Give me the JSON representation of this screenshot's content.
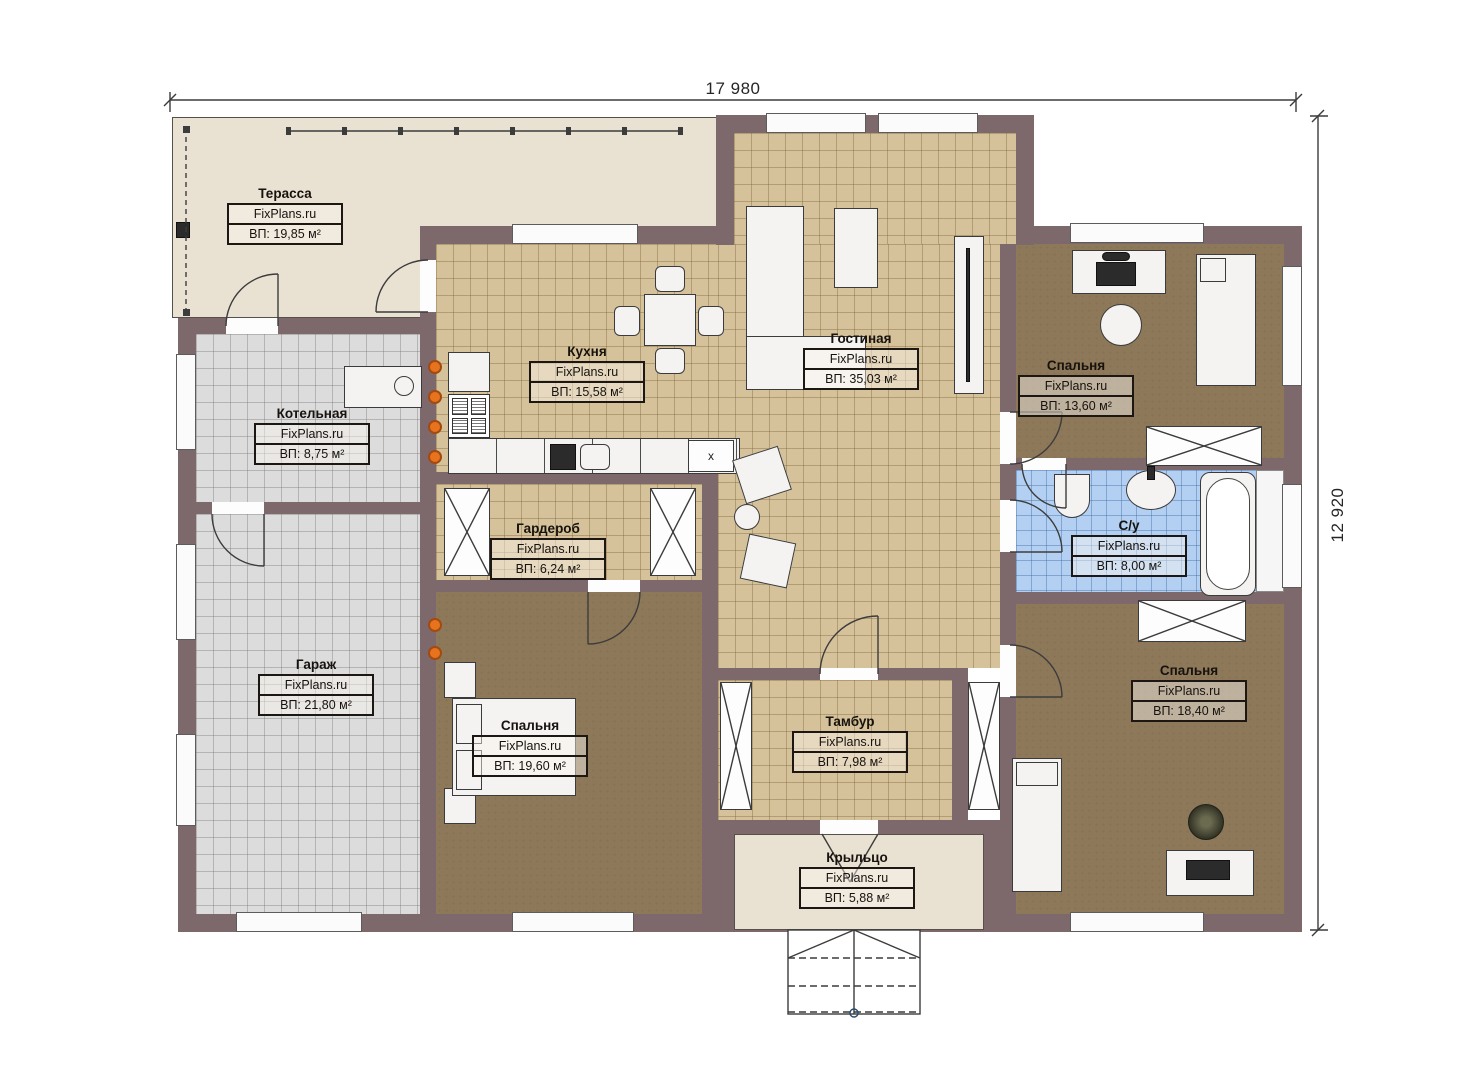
{
  "plan": {
    "watermark": "FixPlans.ru",
    "dimensions": {
      "top_width": "17 980",
      "right_height": "12 920"
    },
    "markers": {
      "kitchen_cabinet": "x"
    },
    "rooms": [
      {
        "id": "terrace",
        "name": "Терасса",
        "area": "ВП: 19,85 м²"
      },
      {
        "id": "kitchen",
        "name": "Кухня",
        "area": "ВП: 15,58 м²"
      },
      {
        "id": "living-room",
        "name": "Гостиная",
        "area": "ВП: 35,03 м²"
      },
      {
        "id": "bedroom-top-right",
        "name": "Спальня",
        "area": "ВП: 13,60 м²"
      },
      {
        "id": "boiler-room",
        "name": "Котельная",
        "area": "ВП: 8,75 м²"
      },
      {
        "id": "garage",
        "name": "Гараж",
        "area": "ВП: 21,80 м²"
      },
      {
        "id": "wardrobe",
        "name": "Гардероб",
        "area": "ВП: 6,24 м²"
      },
      {
        "id": "bedroom-bottom-left",
        "name": "Спальня",
        "area": "ВП: 19,60 м²"
      },
      {
        "id": "vestibule",
        "name": "Тамбур",
        "area": "ВП: 7,98 м²"
      },
      {
        "id": "bathroom",
        "name": "С/у",
        "area": "ВП: 8,00 м²"
      },
      {
        "id": "bedroom-bottom-right",
        "name": "Спальня",
        "area": "ВП: 18,40 м²"
      },
      {
        "id": "porch",
        "name": "Крыльцо",
        "area": "ВП: 5,88 м²"
      }
    ],
    "colors": {
      "wall": "#7d686b",
      "floor_tile_tan": "#d5c29a",
      "floor_brown": "#8d7859",
      "floor_gray": "#dcdcdc",
      "floor_blue": "#b3d0f2",
      "floor_beige": "#e9e1d2",
      "radiator_orange": "#e8731f"
    }
  }
}
